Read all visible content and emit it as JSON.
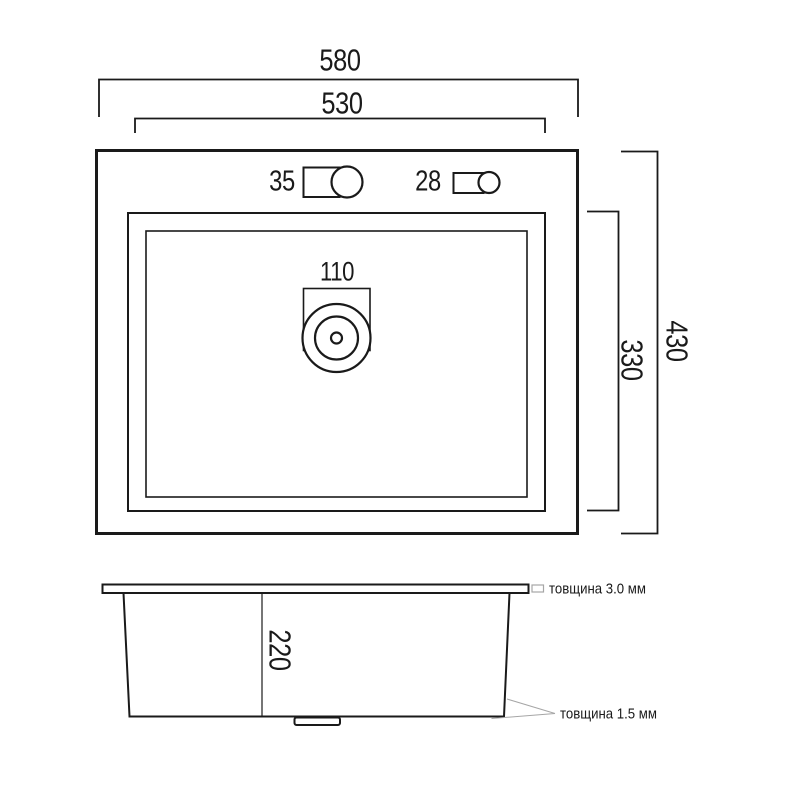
{
  "colors": {
    "line": "#1a1a1a",
    "leader": "#a6a6a6",
    "background": "#ffffff"
  },
  "top_view": {
    "width_overall": "580",
    "width_bowl": "530",
    "depth_overall": "430",
    "depth_bowl": "330",
    "faucet_hole": "35",
    "dispenser_hole": "28",
    "drain_hole": "110"
  },
  "side_view": {
    "height": "220",
    "thickness_top": "товщина 3.0 мм",
    "thickness_bottom": "товщина 1.5 мм"
  }
}
